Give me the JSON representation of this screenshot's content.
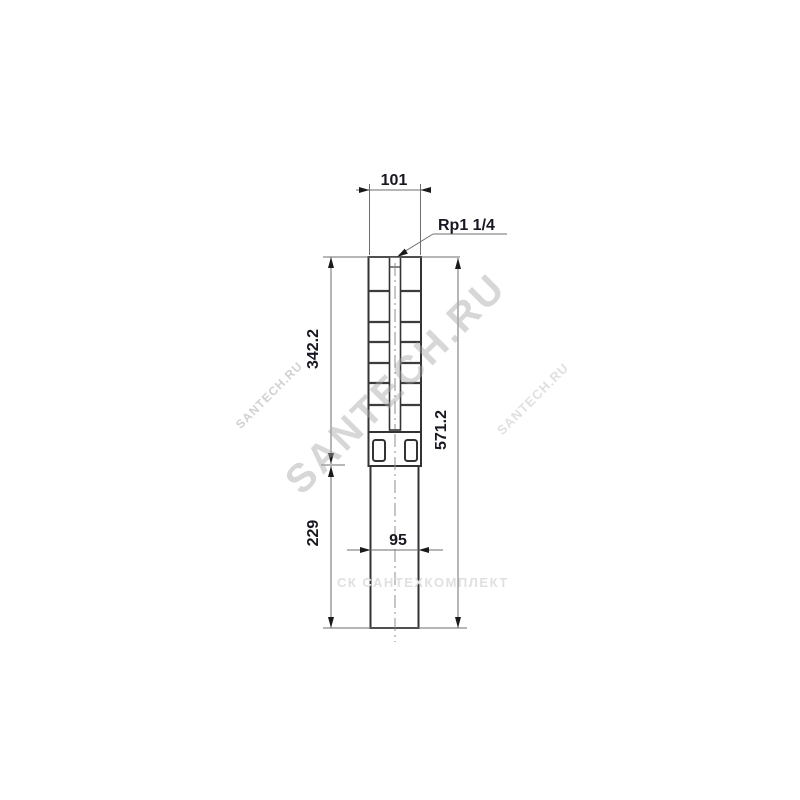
{
  "drawing": {
    "type": "technical-dimension-drawing",
    "subject": "submersible borehole pump outline drawing",
    "dimensions": {
      "top_width": "101",
      "connection_thread": "Rp1 1/4",
      "upper_section_height": "342.2",
      "total_height": "571.2",
      "lower_section_height": "229",
      "bottom_width": "95"
    },
    "colors": {
      "outline": "#333333",
      "dimension_lines": "#6e6e6e",
      "dimension_text": "#181822",
      "watermark_gray": "#c9c9c9",
      "background": "#ffffff"
    }
  },
  "watermarks": {
    "diagonal_large": "SANTECH.RU",
    "diagonal_small_left": "SANTECH.RU",
    "diagonal_small_right": "SANTECH.RU",
    "horizontal_gray": "СК САНТЕХКОМПЛЕКТ"
  }
}
